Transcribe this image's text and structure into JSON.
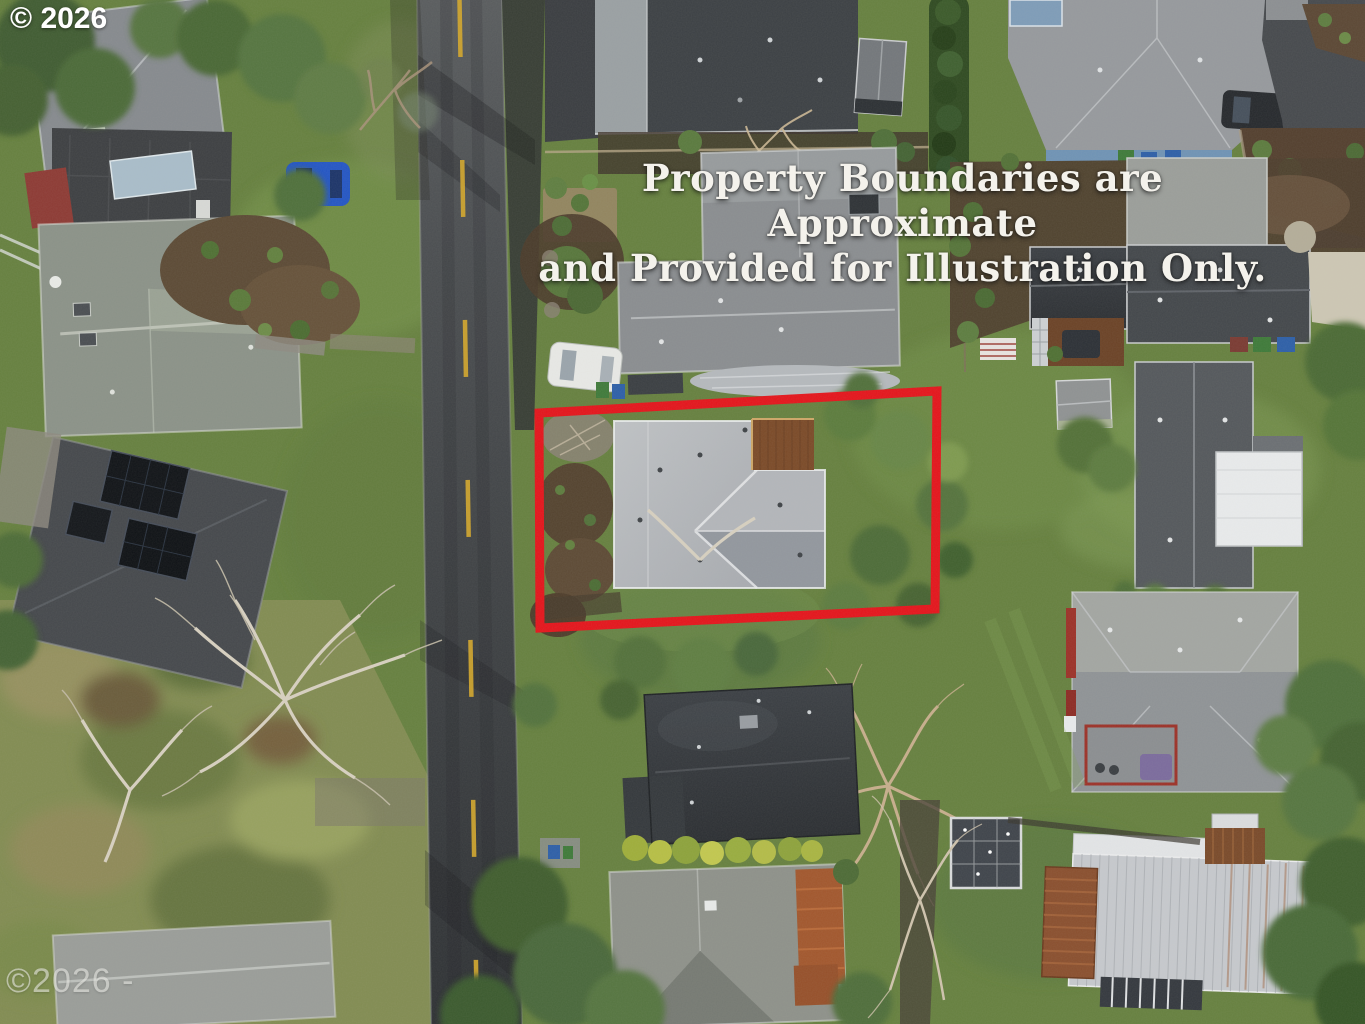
{
  "watermarks": {
    "top": "© 2026",
    "bottom": "©2026 -"
  },
  "overlay": {
    "line1": "Property Boundaries are Approximate",
    "line2": "and Provided for Illustration Only."
  },
  "colors": {
    "boundary_red": "#e4141b",
    "lane_yellow": "#d2a62c",
    "overlay_text": "#f4f2ec",
    "watermark_gray": "#e4e4df"
  }
}
